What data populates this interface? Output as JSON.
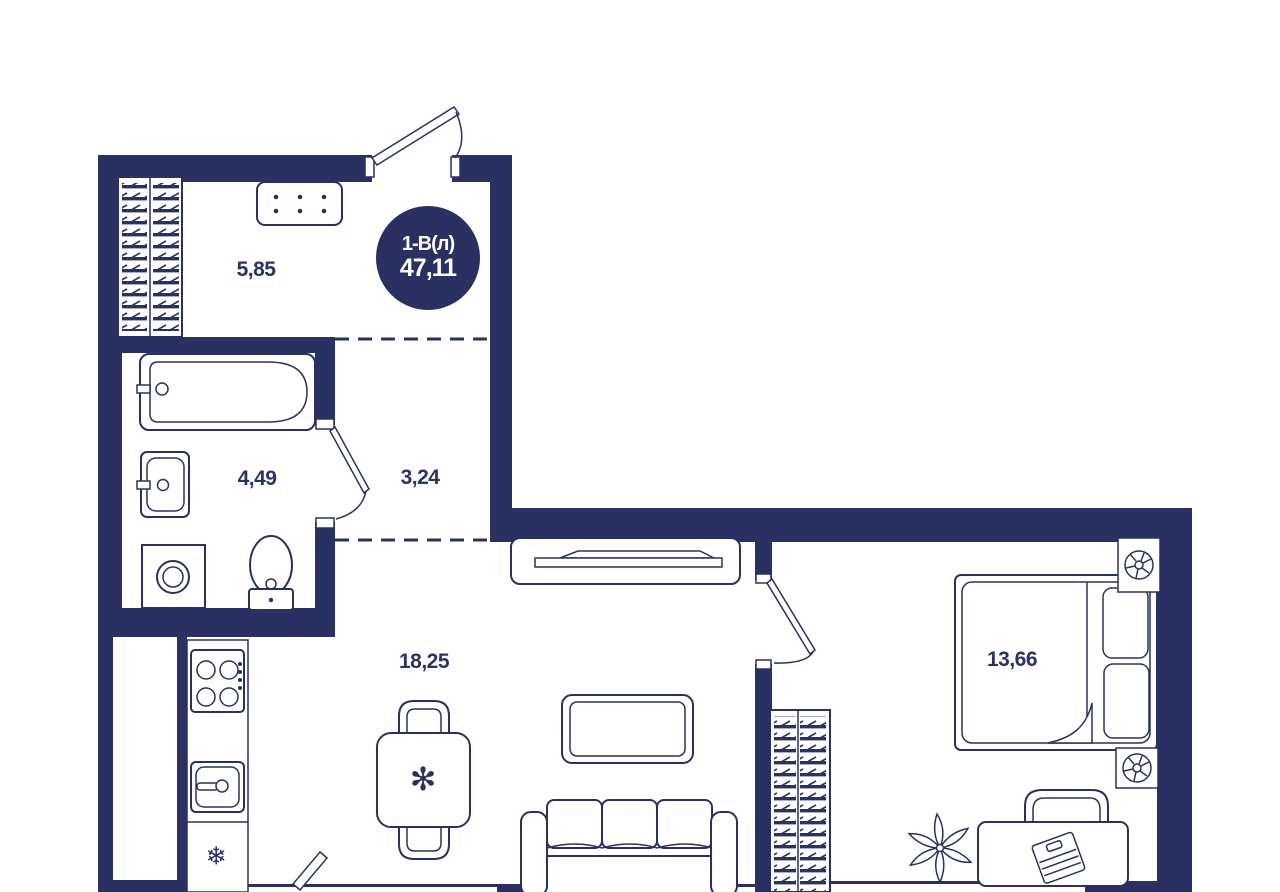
{
  "plan": {
    "unit_label": "1-В(л)",
    "total_area": "47,11",
    "rooms": [
      {
        "name": "hallway",
        "area": "5,85"
      },
      {
        "name": "bathroom",
        "area": "4,49"
      },
      {
        "name": "corridor",
        "area": "3,24"
      },
      {
        "name": "living-kitchen",
        "area": "18,25"
      },
      {
        "name": "bedroom",
        "area": "13,66"
      }
    ],
    "colors": {
      "wall": "#2A3162",
      "line": "#2A3162",
      "label_text": "#2B3365",
      "badge_background": "#2A3162",
      "badge_text": "#FFFFFF",
      "background": "#FFFFFF"
    },
    "icons": {
      "snowflake": "❄",
      "flower": "✻"
    }
  }
}
